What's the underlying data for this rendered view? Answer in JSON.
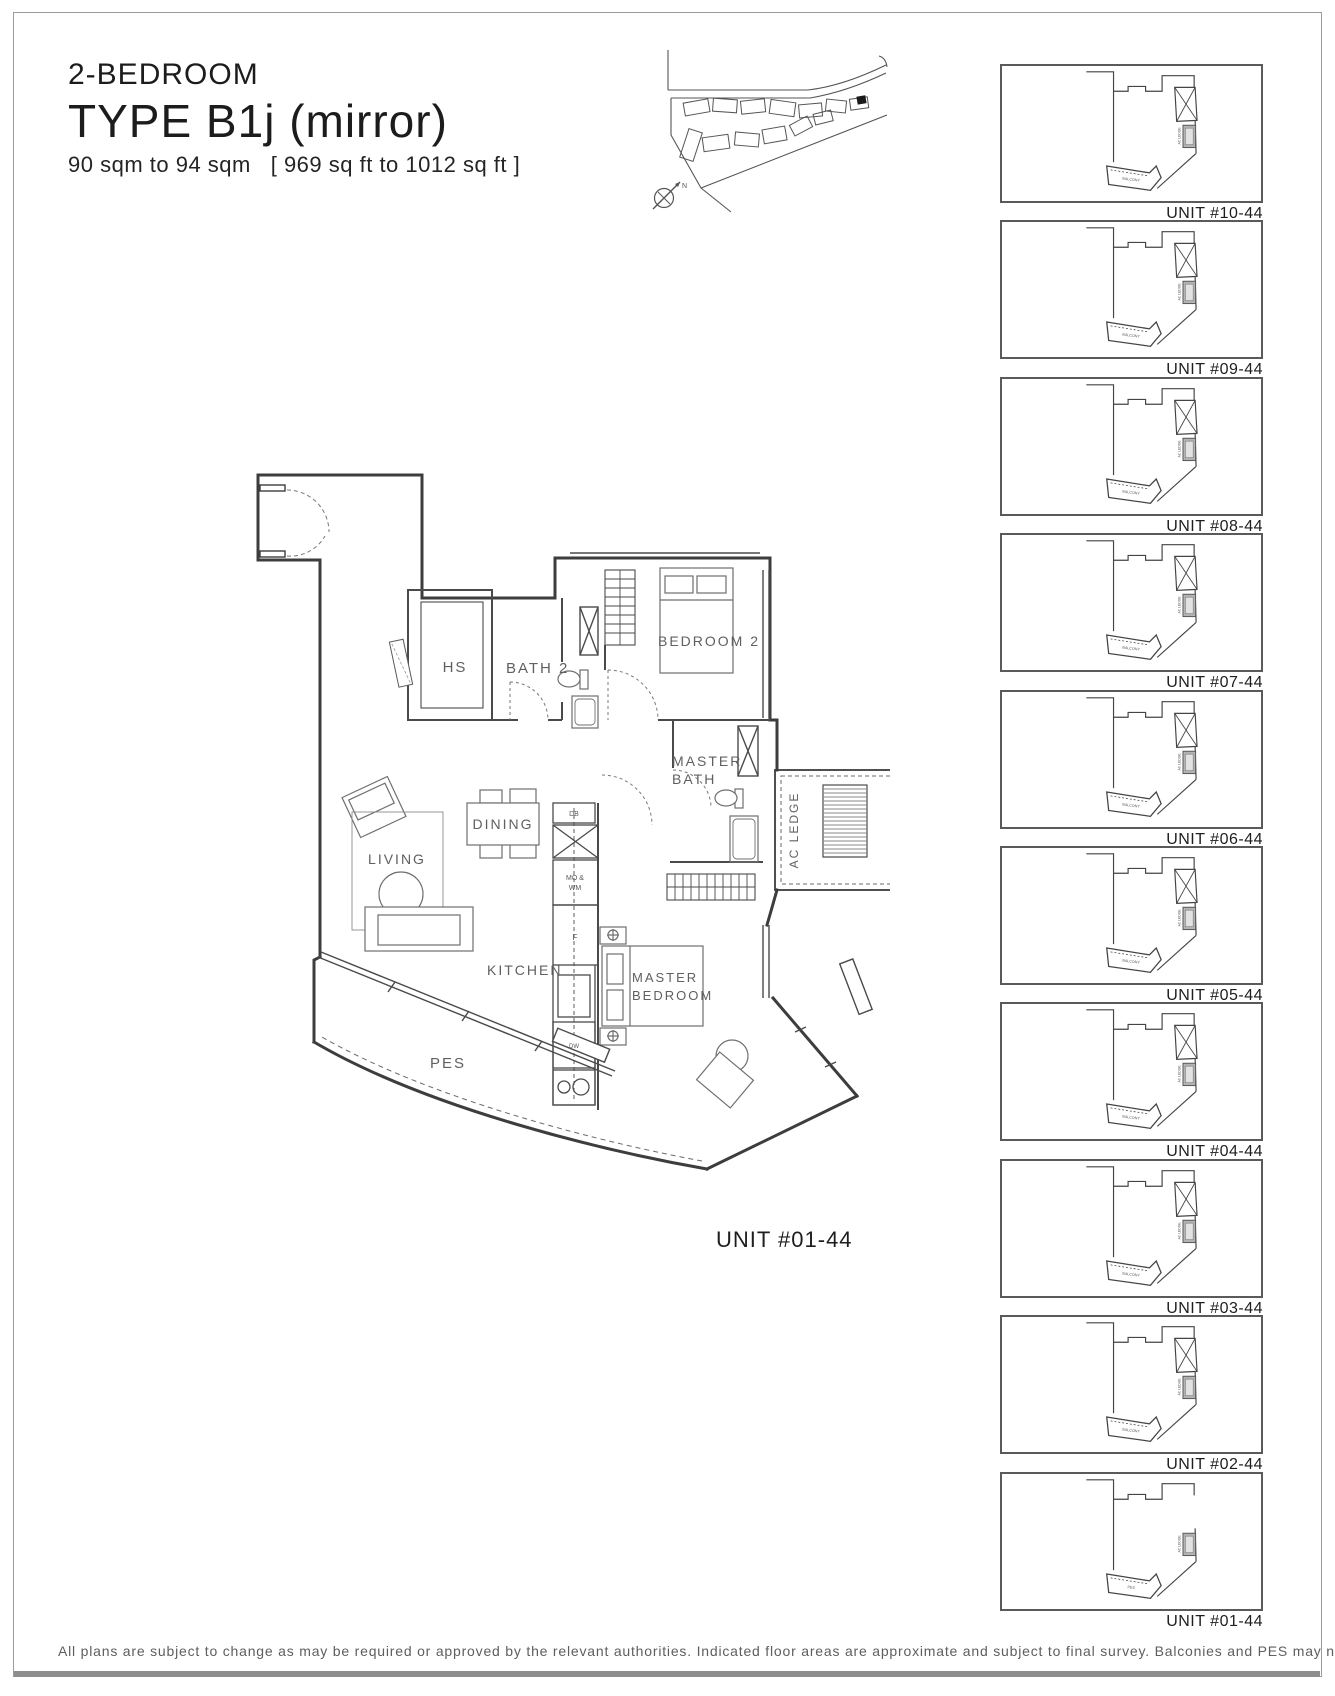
{
  "header": {
    "category": "2-BEDROOM",
    "type_name": "TYPE B1j (mirror)",
    "area_metric": "90 sqm to 94 sqm",
    "area_imperial": "[ 969 sq ft to 1012 sq ft ]"
  },
  "site_map": {
    "north_label": "N"
  },
  "floor_plan": {
    "unit_label": "UNIT #01-44",
    "rooms": {
      "hs": "HS",
      "bath2": "BATH 2",
      "bedroom2": "BEDROOM 2",
      "master_bath_line1": "MASTER",
      "master_bath_line2": "BATH",
      "ac_ledge": "AC LEDGE",
      "dining": "DINING",
      "living": "LIVING",
      "kitchen": "KITCHEN",
      "master_bedroom_line1": "MASTER",
      "master_bedroom_line2": "BEDROOM",
      "pes": "PES"
    },
    "appliances": {
      "db": "DB",
      "mo_wm_line1": "MO &",
      "mo_wm_line2": "WM",
      "f": "F",
      "dw": "DW"
    }
  },
  "thumb_common": {
    "ac_label": "AC LEDGE"
  },
  "thumbnails": [
    {
      "label": "UNIT #10-44",
      "balcony_label": "BALCONY",
      "variant": "typical"
    },
    {
      "label": "UNIT #09-44",
      "balcony_label": "BALCONY",
      "variant": "typical"
    },
    {
      "label": "UNIT #08-44",
      "balcony_label": "BALCONY",
      "variant": "typical"
    },
    {
      "label": "UNIT #07-44",
      "balcony_label": "BALCONY",
      "variant": "typical"
    },
    {
      "label": "UNIT #06-44",
      "balcony_label": "BALCONY",
      "variant": "typical"
    },
    {
      "label": "UNIT #05-44",
      "balcony_label": "BALCONY",
      "variant": "typical"
    },
    {
      "label": "UNIT #04-44",
      "balcony_label": "BALCONY",
      "variant": "typical"
    },
    {
      "label": "UNIT #03-44",
      "balcony_label": "BALCONY",
      "variant": "typical"
    },
    {
      "label": "UNIT #02-44",
      "balcony_label": "BALCONY",
      "variant": "typical"
    },
    {
      "label": "UNIT #01-44",
      "balcony_label": "PES",
      "variant": "ground"
    }
  ],
  "footer": {
    "disclaimer": "All plans are subject to change as may be required or approved by the relevant authorities. Indicated floor areas are approximate and subject to final survey. Balconies and PES may not be fully covered."
  },
  "colors": {
    "wall": "#3d3d3d",
    "furniture": "#6f6f6f",
    "label": "#606060",
    "accent_gray": "#b3b3b3"
  }
}
